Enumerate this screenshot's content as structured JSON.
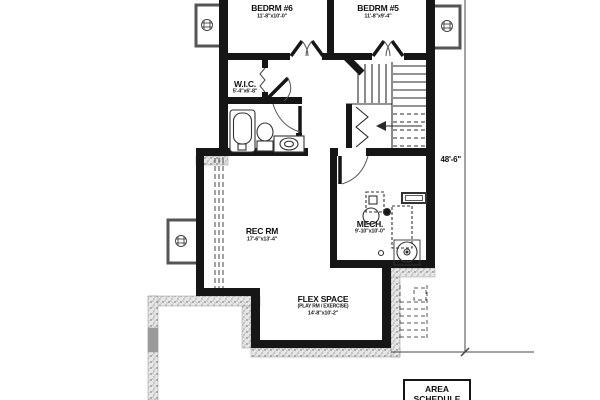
{
  "rooms": {
    "bedrm6": {
      "name": "BEDRM #6",
      "dims": "11'-8\"x10'-0\""
    },
    "bedrm5": {
      "name": "BEDRM #5",
      "dims": "11'-8\"x9'-4\""
    },
    "wic": {
      "name": "W.I.C.",
      "dims": "5'-4\"x6'-8\""
    },
    "rec_rm": {
      "name": "REC RM",
      "dims": "17'-6\"x13'-4\""
    },
    "mech": {
      "name": "MECH.",
      "dims": "9'-10\"x10'-0\""
    },
    "flex": {
      "name": "FLEX SPACE",
      "subtitle": "(PLAY RM / EXERCISE)",
      "dims": "14'-8\"x10'-2\""
    }
  },
  "dimension_annotations": {
    "overall_height": "48'-6\""
  },
  "schedule_box": {
    "title_line1": "AREA",
    "title_line2": "SCHEDULE"
  },
  "colors": {
    "wall": "#161616",
    "background": "#ffffff",
    "thin_line": "#3a3a3a"
  }
}
